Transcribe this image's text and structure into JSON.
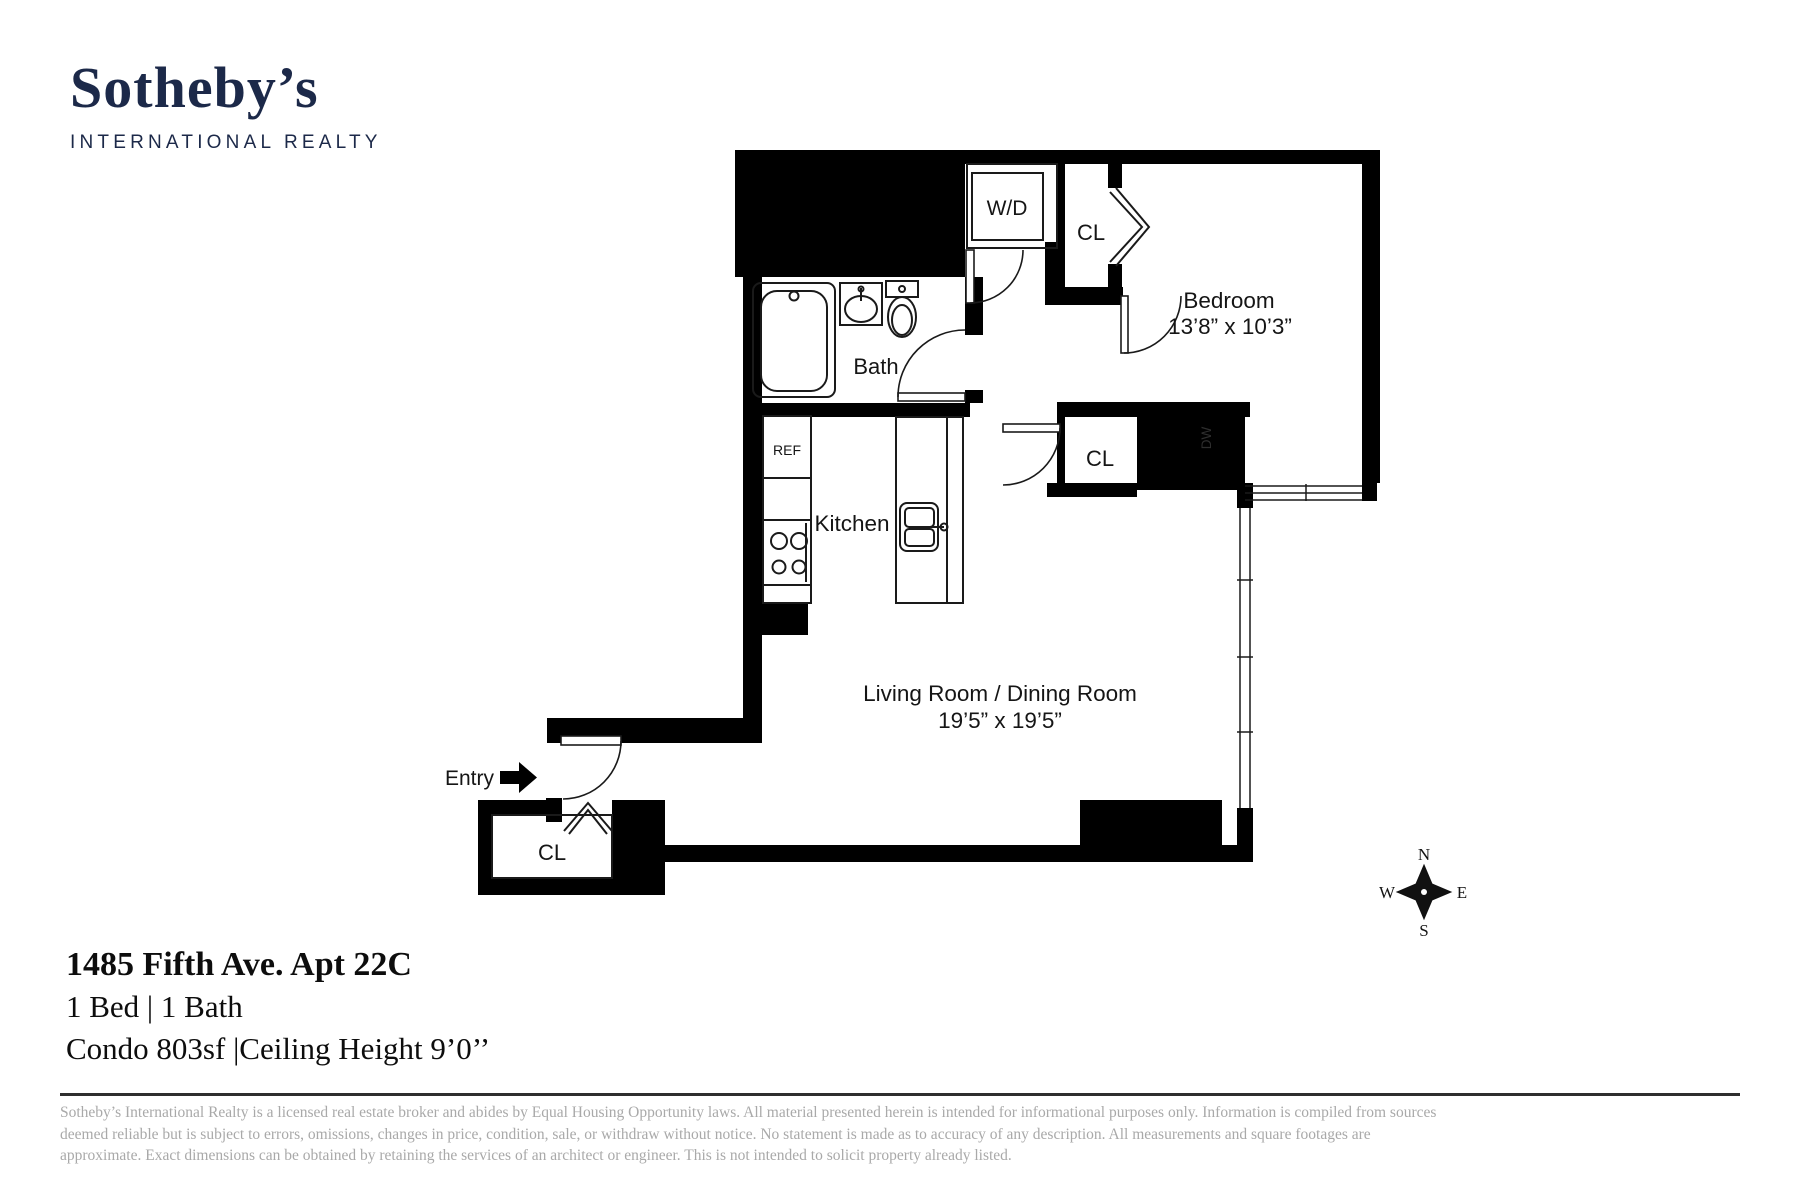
{
  "logo": {
    "brand": "Sotheby’s",
    "division": "INTERNATIONAL REALTY"
  },
  "plan": {
    "rooms": {
      "bedroom": {
        "label": "Bedroom",
        "dims": "13’8” x 10’3”"
      },
      "living": {
        "label": "Living Room / Dining Room",
        "dims": "19’5” x 19’5”"
      },
      "bath": {
        "label": "Bath"
      },
      "kitchen": {
        "label": "Kitchen"
      },
      "wd": {
        "label": "W/D"
      },
      "ref": {
        "label": "REF"
      },
      "dw": {
        "label": "DW"
      },
      "closet_top": {
        "label": "CL"
      },
      "closet_mid": {
        "label": "CL"
      },
      "closet_bottom": {
        "label": "CL"
      },
      "entry": {
        "label": "Entry"
      }
    },
    "compass": {
      "n": "N",
      "s": "S",
      "e": "E",
      "w": "W"
    }
  },
  "property": {
    "address": "1485 Fifth Ave. Apt 22C",
    "beds_baths": "1 Bed | 1 Bath",
    "details": "Condo  803sf |Ceiling Height 9’0’’"
  },
  "disclaimer": {
    "line1": "Sotheby’s International Realty is a licensed real estate broker and abides by Equal Housing Opportunity laws. All material presented herein is intended for informational purposes only. Information is compiled from sources",
    "line2": "deemed reliable but is subject to errors, omissions, changes in price, condition, sale, or withdraw without notice. No statement is made as to accuracy of any description. All measurements and square footages are",
    "line3": "approximate. Exact dimensions can be obtained by retaining the services of an architect or engineer. This is not intended to solicit property already listed."
  },
  "colors": {
    "brand_navy": "#1c2949",
    "wall_black": "#000000",
    "line_dark": "#1a1a1a",
    "disclaimer_gray": "#a9a9a9"
  }
}
